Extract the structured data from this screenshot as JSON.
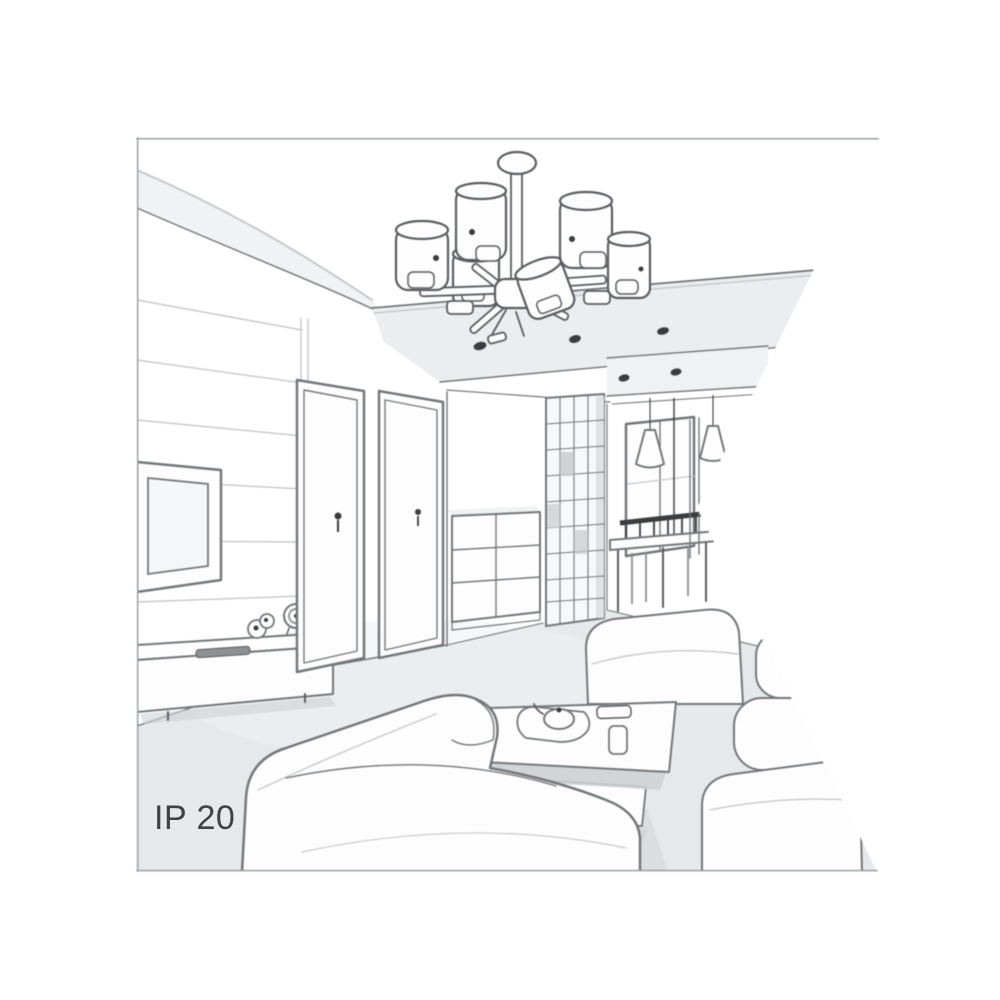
{
  "illustration": {
    "type": "grayscale line-art interior sketch",
    "subject": "Perspective sketch of a modern living room with a six-shade ceiling chandelier, recessed spotlights, TV feature wall with sideboard, hallway with two doors, chest of drawers, slatted wardrobe, dining nook with window and two cone pendant lamps, sofas, ottoman and a coffee table with tea set; drawing clipped by a triangular notch on its right edge",
    "ip_rating_label": "IP 20",
    "colors": {
      "background": "#ffffff",
      "ink": "#74777a",
      "ink_strong": "#5a5d60",
      "ink_soft": "#c6c9cb",
      "fill_white": "#fdfdfe",
      "wall_tint": "#f0f1f3",
      "soffit_tint": "#ebedef",
      "floor_tint": "#e6e8ea",
      "shadow_tint": "#ced1d4",
      "dark_detail": "#3a3c3e",
      "label_color": "#3f4245",
      "frame_border": "#9aa0a4"
    },
    "objects": [
      "ceiling chandelier with six cylindrical shades",
      "ceiling canopy and stem",
      "recessed ceiling spotlights",
      "slatted feature wall",
      "wall-mounted TV",
      "low sideboard with clock, figurine and remote control",
      "two interior doors with handles",
      "chest of drawers",
      "slatted wardrobe unit",
      "dining nook window",
      "two cone pendant lamps",
      "dining table with chairs",
      "main corner sofa",
      "ottoman seat",
      "right-hand sofa",
      "coffee table with tray, teapot and cups",
      "IP 20 protection-rating label"
    ]
  }
}
